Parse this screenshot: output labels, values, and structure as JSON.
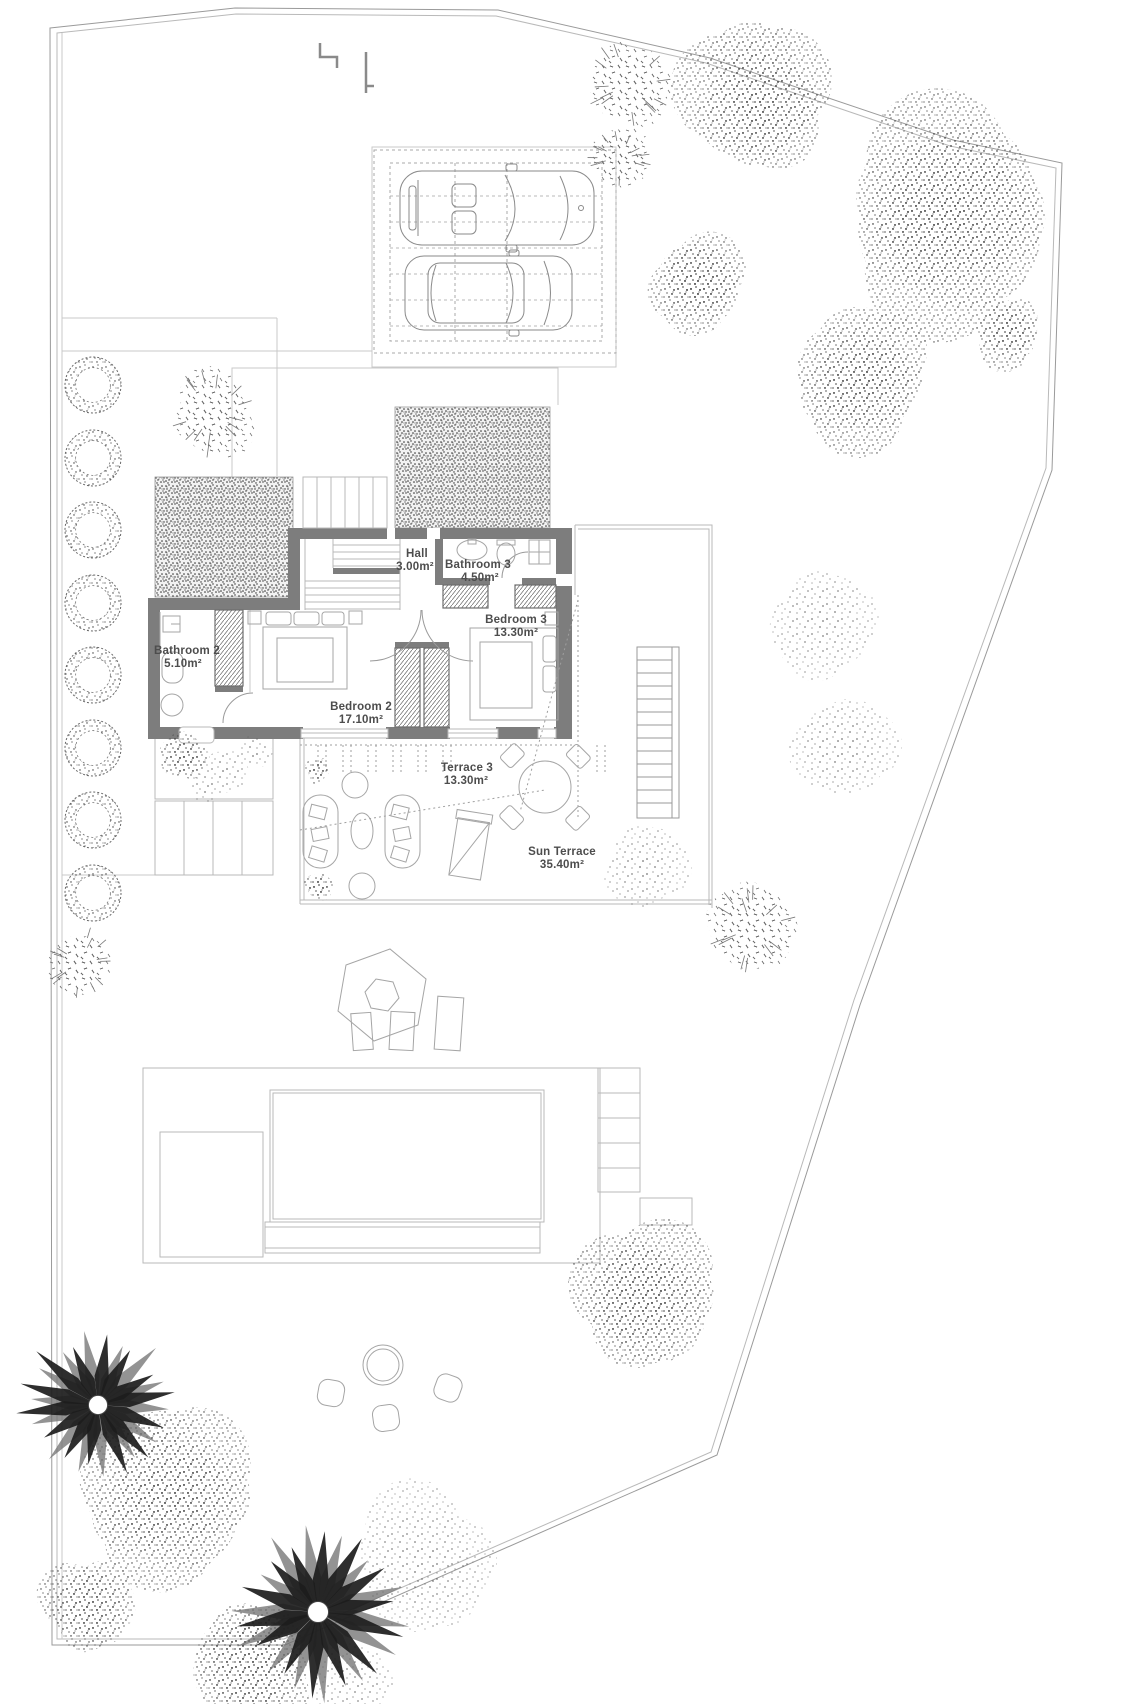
{
  "drawing": {
    "kind": "villa first-floor site plan",
    "rooms": {
      "hall": {
        "name": "Hall",
        "area": "3.00m²"
      },
      "bathroom3": {
        "name": "Bathroom 3",
        "area": "4.50m²"
      },
      "bedroom3": {
        "name": "Bedroom 3",
        "area": "13.30m²"
      },
      "bathroom2": {
        "name": "Bathroom 2",
        "area": "5.10m²"
      },
      "bedroom2": {
        "name": "Bedroom 2",
        "area": "17.10m²"
      },
      "terrace3": {
        "name": "Terrace 3",
        "area": "13.30m²"
      },
      "sun_terrace": {
        "name": "Sun Terrace",
        "area": "35.40m²"
      }
    },
    "colors": {
      "background": "#ffffff",
      "wall_fill": "#7d7d7d",
      "line_light": "#c9c9c9",
      "line_mid": "#9a9a9a",
      "label_text": "#4d4d4d",
      "vegetation_dark": "#1d1d1d"
    }
  }
}
